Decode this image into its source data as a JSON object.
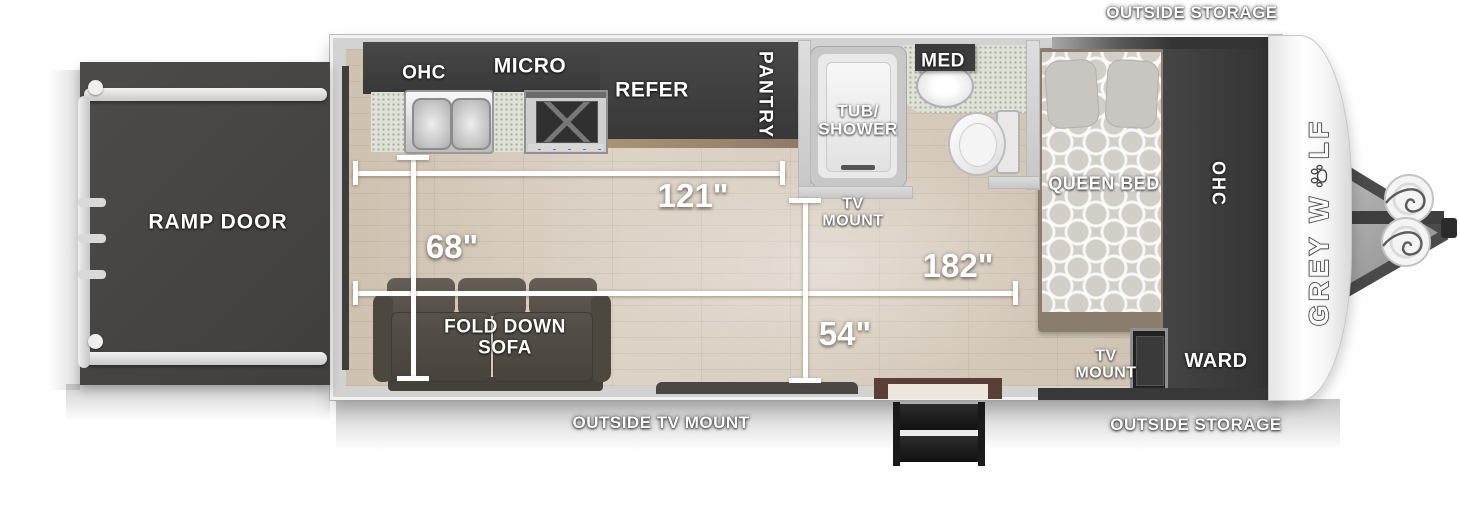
{
  "brand": {
    "name": "GREY WOLF",
    "logo_pre": "GREY W",
    "logo_post": "LF",
    "paw_icon": "paw-icon"
  },
  "exterior": {
    "outside_storage_top": "OUTSIDE STORAGE",
    "outside_storage_bottom": "OUTSIDE STORAGE",
    "outside_tv_mount": "OUTSIDE TV MOUNT",
    "ramp_door": "RAMP DOOR"
  },
  "kitchen": {
    "ohc": "OHC",
    "micro": "MICRO",
    "refer": "REFER",
    "pantry": "PANTRY"
  },
  "bathroom": {
    "tub_shower": "TUB/\nSHOWER",
    "med": "MED",
    "tv_mount": "TV\nMOUNT"
  },
  "bedroom": {
    "queen_bed": "QUEEN BED",
    "ohc": "OHC",
    "ward": "WARD",
    "tv_mount": "TV\nMOUNT"
  },
  "living": {
    "fold_down_sofa": "FOLD DOWN\nSOFA"
  },
  "measurements": {
    "dim_121": "121\"",
    "dim_68": "68\"",
    "dim_182": "182\"",
    "dim_54": "54\""
  },
  "colors": {
    "cabinet_dark": "#3d3d3d",
    "wall_gray": "#d2d2d2",
    "floor_wood": "#d7ccbe",
    "sofa_gray": "#55504a",
    "door_brown": "#5a3f38",
    "step_black": "#1a1a1a",
    "label_white": "#ffffff"
  }
}
